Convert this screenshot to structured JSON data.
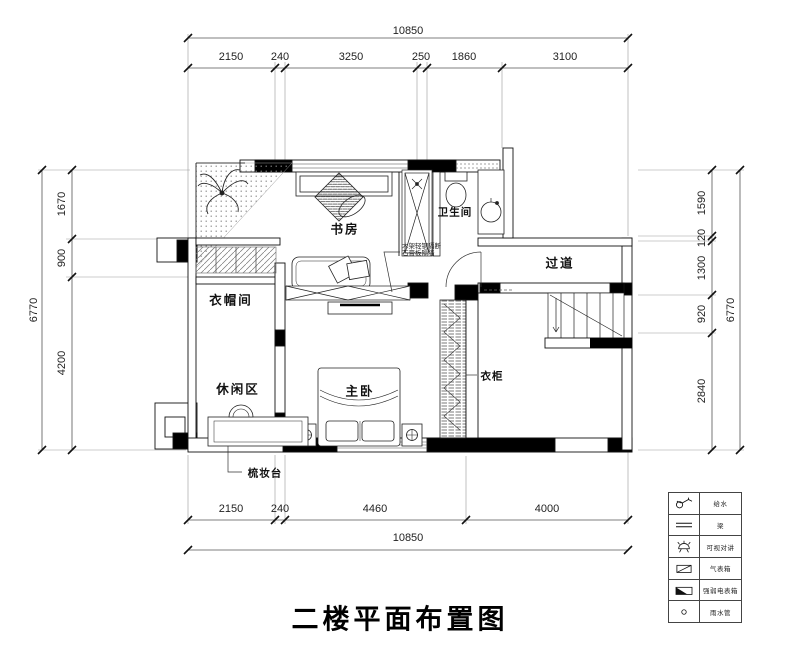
{
  "title": "二楼平面布置图",
  "dimensions": {
    "top": {
      "total": "10850",
      "segments": [
        "2150",
        "240",
        "3250",
        "250",
        "1860",
        "3100"
      ]
    },
    "bottom": {
      "total": "10850",
      "segments": [
        "2150",
        "240",
        "4460",
        "4000"
      ]
    },
    "left": {
      "total": "6770",
      "segments": [
        "1670",
        "900",
        "4200"
      ]
    },
    "right": {
      "total": "6770",
      "segments": [
        "1590",
        "120",
        "1300",
        "920",
        "2840"
      ]
    }
  },
  "rooms": {
    "study": "书房",
    "bathroom": "卫生间",
    "corridor": "过道",
    "cloakroom": "衣帽间",
    "leisure_area": "休闲区",
    "master_bedroom": "主卧",
    "wardrobe": "衣柜",
    "dressing_table": "梳妆台"
  },
  "annotations": {
    "partition_line1": "木架轻钢隔断",
    "partition_line2": "石膏板隔墙"
  },
  "legend": {
    "items": [
      {
        "icon": "faucet",
        "label": "给水"
      },
      {
        "icon": "beam",
        "label": "梁"
      },
      {
        "icon": "video-intercom",
        "label": "可视对讲"
      },
      {
        "icon": "gas-meter-box",
        "label": "气表箱"
      },
      {
        "icon": "power-meter-box",
        "label": "强弱电表箱"
      },
      {
        "icon": "rain-pipe",
        "label": "雨水管"
      }
    ]
  },
  "colors": {
    "line": "#1a1a1a",
    "wall_fill": "#000000",
    "dim_line": "#555555",
    "background": "#ffffff"
  }
}
